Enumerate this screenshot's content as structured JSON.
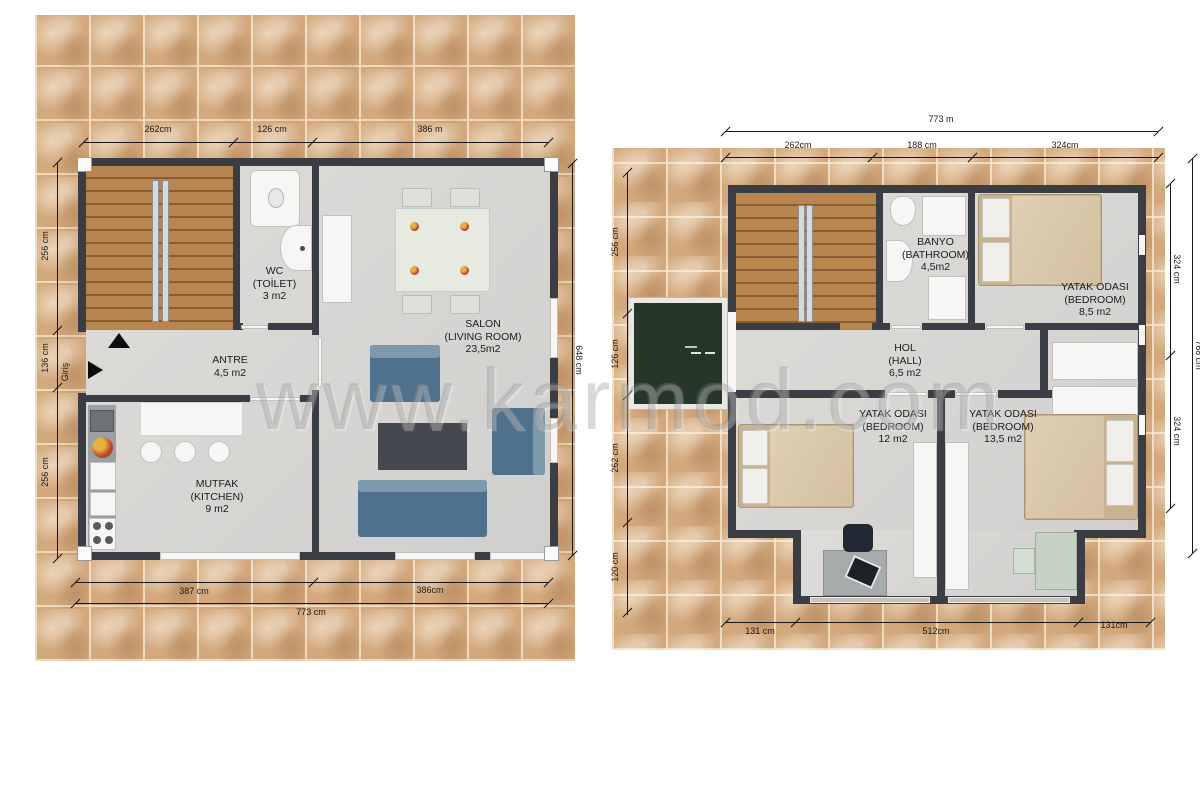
{
  "watermark": "www.karmod.com",
  "colors": {
    "tile": "#d2a87c",
    "wall": "#3a3d43",
    "floor": "#d8d6d4",
    "stair_wood": "#a97843",
    "sofa_blue": "#4f718b",
    "bed_beige": "#d9c7ab",
    "balcony_green": "#263729"
  },
  "floor1": {
    "rooms": {
      "wc": [
        "WC",
        "(TOİLET)",
        "3 m2"
      ],
      "antre": [
        "ANTRE",
        "4,5 m2"
      ],
      "salon": [
        "SALON",
        "(LIVING ROOM)",
        "23,5m2"
      ],
      "mutfak": [
        "MUTFAK",
        "(KITCHEN)",
        "9 m2"
      ]
    },
    "entrance": "Giriş",
    "dims": {
      "top": [
        "262cm",
        "126 cm",
        "386 m"
      ],
      "left": [
        "256 cm",
        "136 cm",
        "256 cm"
      ],
      "right": "648 cm",
      "bottom": [
        "387 cm",
        "386cm"
      ],
      "bottom_total": "773 cm"
    }
  },
  "floor2": {
    "rooms": {
      "banyo": [
        "BANYO",
        "(BATHROOM)",
        "4,5m2"
      ],
      "bedroom_top": [
        "YATAK ODASI",
        "(BEDROOM)",
        "8,5 m2"
      ],
      "hol": [
        "HOL",
        "(HALL)",
        "6,5 m2"
      ],
      "bedroom_left": [
        "YATAK ODASI",
        "(BEDROOM)",
        "12 m2"
      ],
      "bedroom_right": [
        "YATAK ODASI",
        "(BEDROOM)",
        "13,5 m2"
      ]
    },
    "dims": {
      "top_total": "773 m",
      "top": [
        "262cm",
        "188 cm",
        "324cm"
      ],
      "left": [
        "256 cm",
        "126 cm",
        "262 cm",
        "120 cm"
      ],
      "right": [
        "324 cm",
        "324 cm"
      ],
      "right_total": "768 cm",
      "bottom": [
        "131 cm",
        "512cm",
        "131cm"
      ]
    }
  }
}
